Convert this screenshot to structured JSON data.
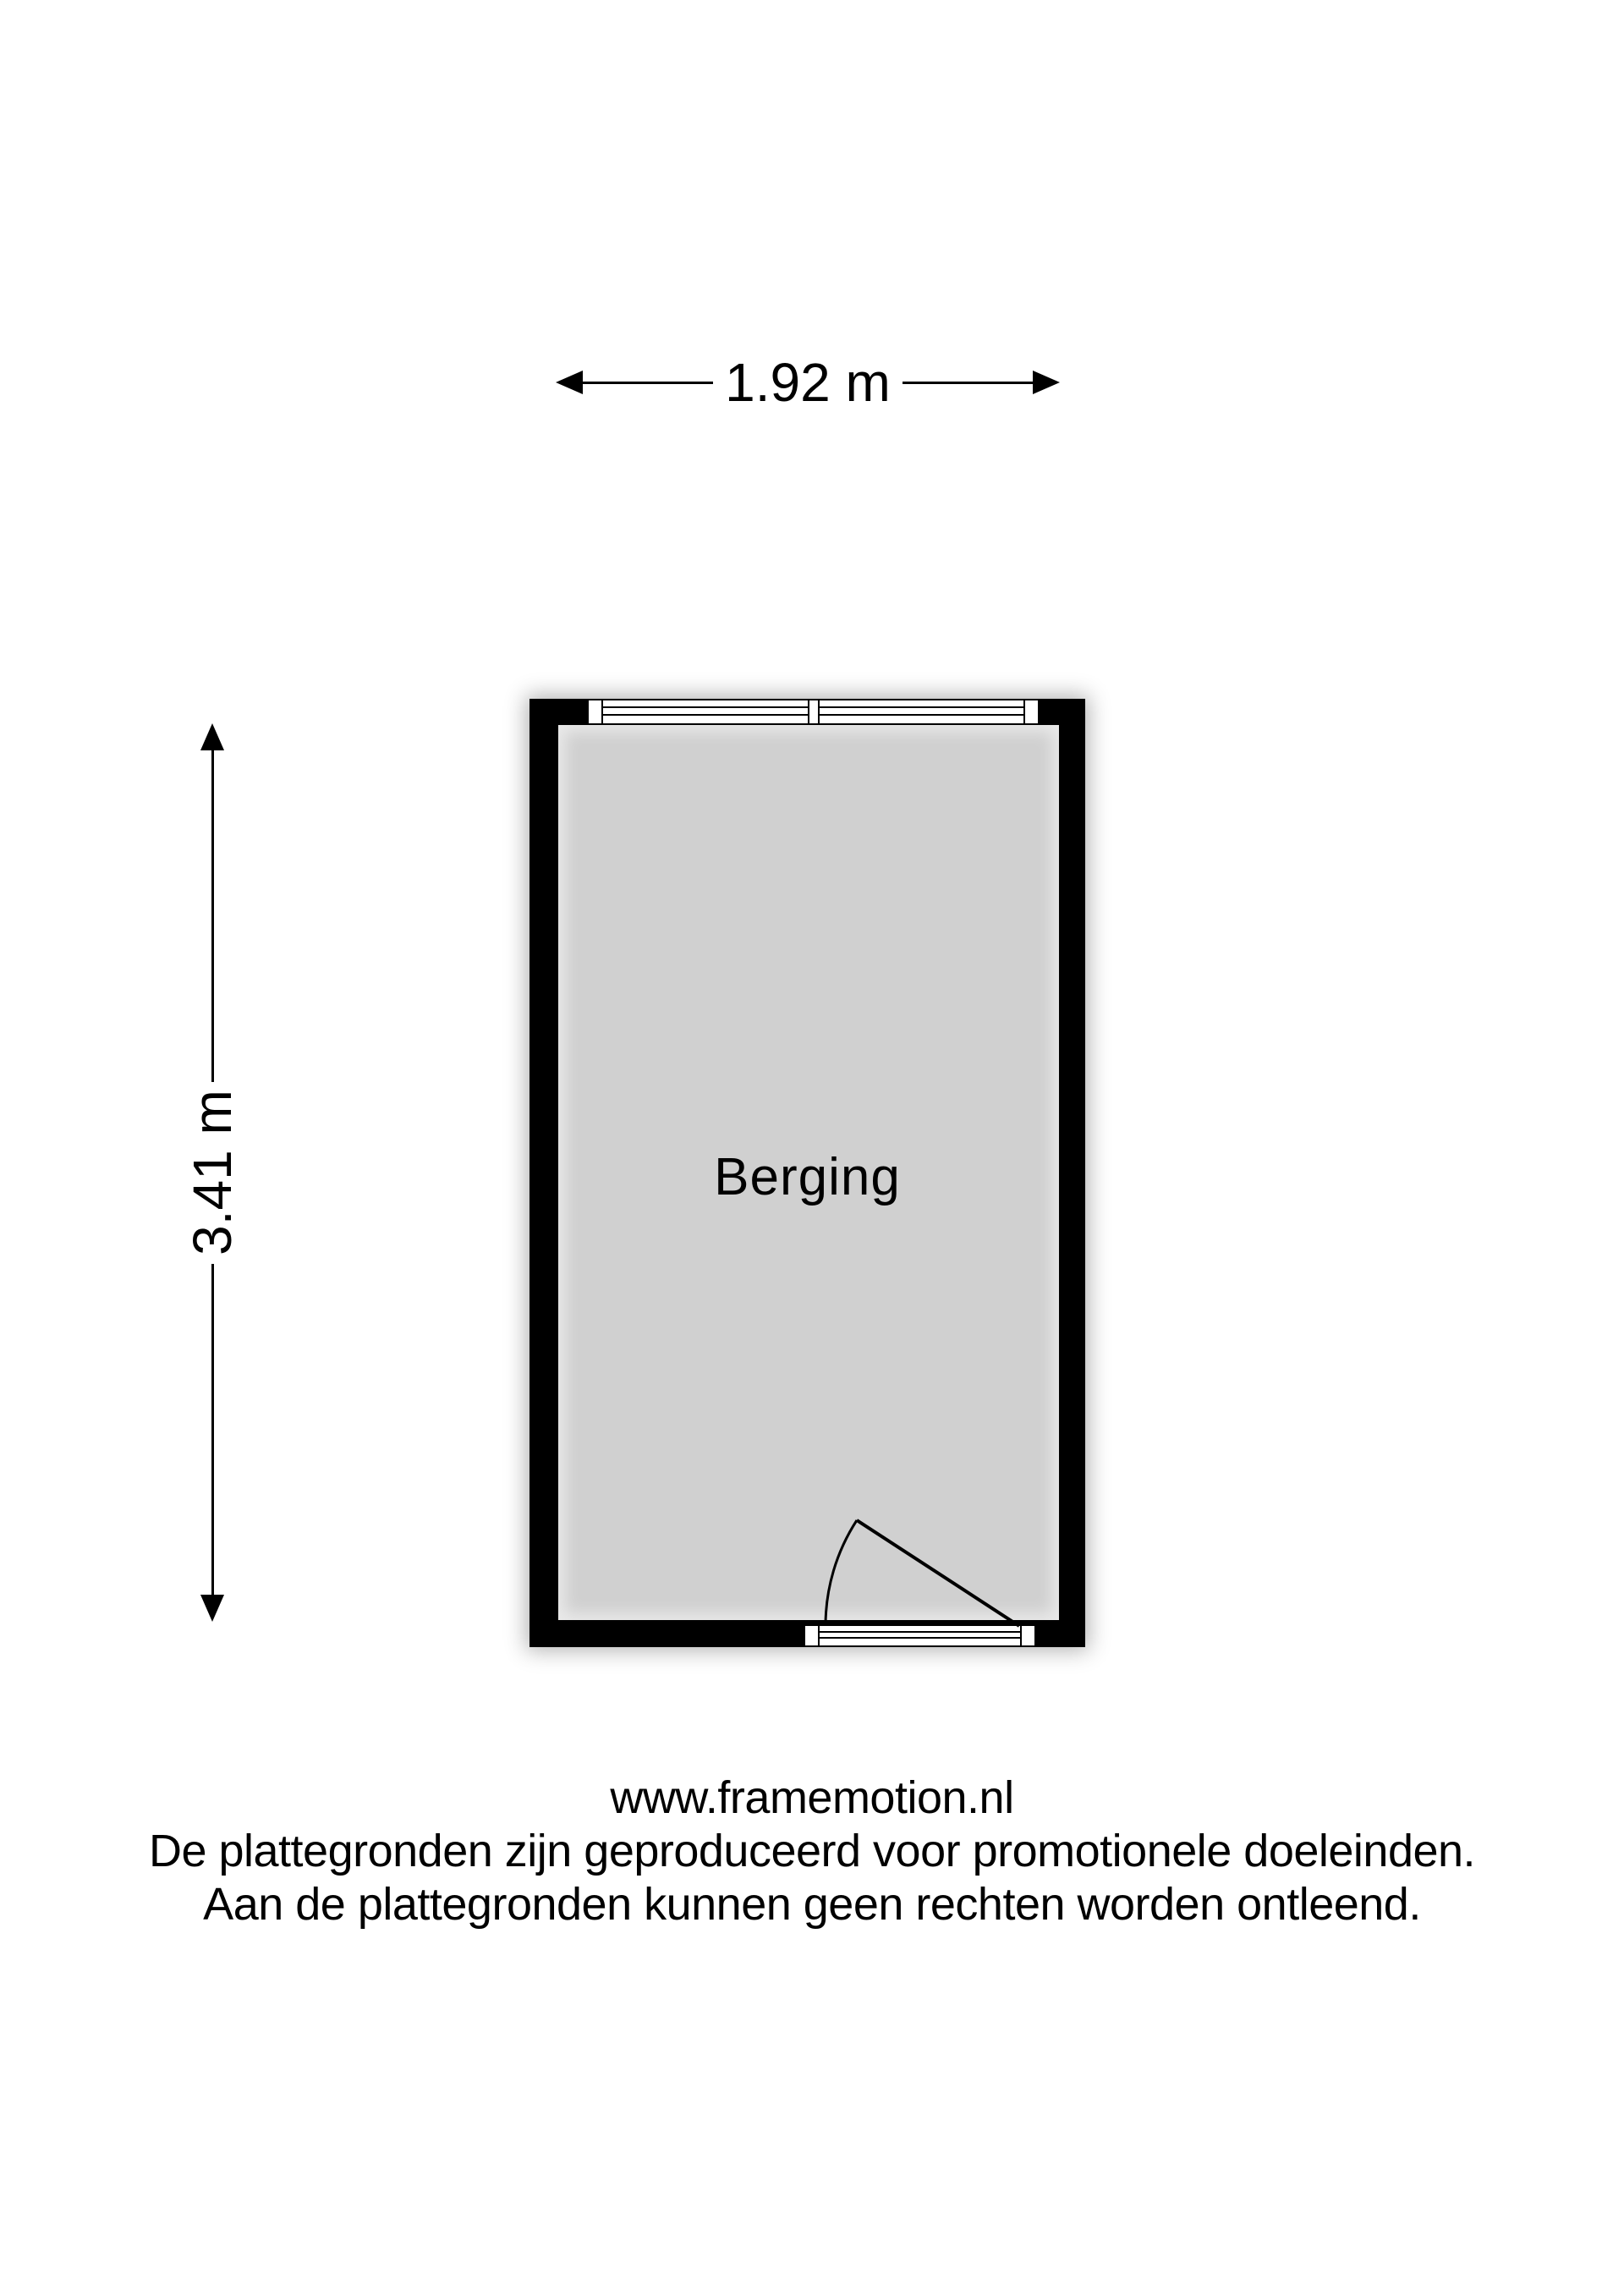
{
  "floorplan": {
    "room_label": "Berging",
    "width_dimension": "1.92 m",
    "height_dimension": "3.41 m"
  },
  "footer": {
    "website": "www.framemotion.nl",
    "disclaimer_line1": "De plattegronden zijn geproduceerd voor promotionele doeleinden.",
    "disclaimer_line2": "Aan de plattegronden kunnen geen rechten worden ontleend."
  },
  "colors": {
    "wall": "#000000",
    "fill": "#d0d0d0",
    "bg": "#ffffff",
    "ink": "#000000"
  }
}
